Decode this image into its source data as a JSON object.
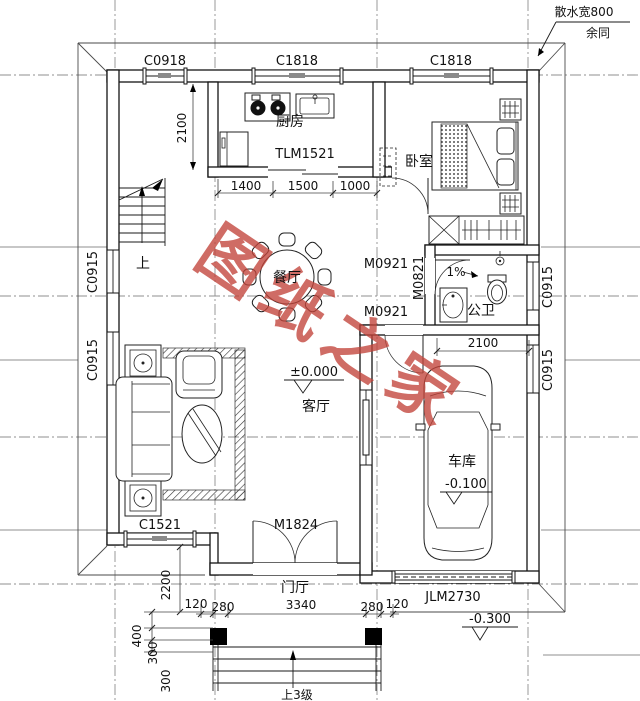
{
  "plan": {
    "title_watermark": "图纸之家",
    "notes": {
      "splash_width": "散水宽800",
      "rest_same": "余同",
      "slope": "1%",
      "up": "上",
      "up_3_steps": "上3级"
    },
    "rooms": {
      "kitchen": "厨房",
      "bedroom": "卧室",
      "dining": "餐厅",
      "living": "客厅",
      "bathroom": "公卫",
      "garage": "车库",
      "foyer": "门厅"
    },
    "openings": {
      "c0918": "C0918",
      "c1818": "C1818",
      "c0915": "C0915",
      "c1521": "C1521",
      "tlm1521": "TLM1521",
      "m0921": "M0921",
      "m0821": "M0821",
      "m1824": "M1824",
      "jlm2730": "JLM2730"
    },
    "levels": {
      "living": "±0.000",
      "garage": "-0.100",
      "entry": "-0.300"
    },
    "dims": {
      "d2100": "2100",
      "d1400": "1400",
      "d1500": "1500",
      "d1000": "1000",
      "d2200": "2200",
      "d120": "120",
      "d280": "280",
      "d3340": "3340",
      "d400": "400",
      "d300": "300"
    }
  },
  "colors": {
    "watermark": "#c2443a",
    "line": "#141414",
    "axis_gray": "#8f8f8f"
  }
}
